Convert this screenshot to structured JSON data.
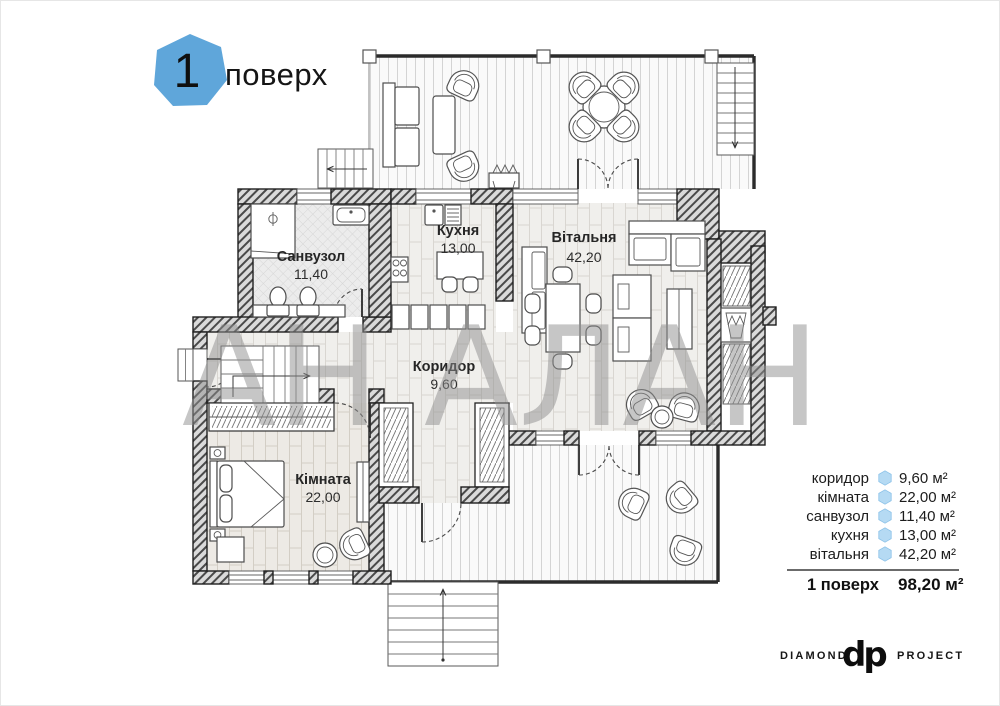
{
  "title": {
    "floor_number": "1",
    "floor_label": "поверх"
  },
  "watermark": "АН АЛАН",
  "rooms": {
    "bathroom": {
      "name": "Санвузол",
      "area": "11,40"
    },
    "kitchen": {
      "name": "Кухня",
      "area": "13,00"
    },
    "living": {
      "name": "Вітальня",
      "area": "42,20"
    },
    "corridor": {
      "name": "Коридор",
      "area": "9,60"
    },
    "bedroom": {
      "name": "Кімната",
      "area": "22,00"
    }
  },
  "legend": {
    "rows": [
      {
        "label": "коридор",
        "value": "9,60 м²"
      },
      {
        "label": "кімната",
        "value": "22,00 м²"
      },
      {
        "label": "санвузол",
        "value": "11,40 м²"
      },
      {
        "label": "кухня",
        "value": "13,00 м²"
      },
      {
        "label": "вітальня",
        "value": "42,20 м²"
      }
    ],
    "total": {
      "label": "1 поверх",
      "value": "98,20 м²"
    }
  },
  "logo": {
    "left": "DIAMOND",
    "monogram": "dp",
    "right": "PROJECT"
  },
  "colors": {
    "accent_blue": "#5fa6da",
    "bullet_blue": "#b5daf3",
    "bullet_edge": "#8cc2e8"
  }
}
